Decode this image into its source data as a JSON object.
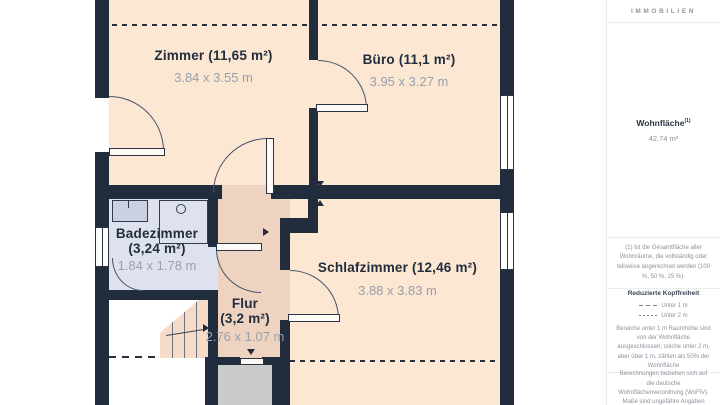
{
  "plan": {
    "rooms": {
      "zimmer": {
        "name": "Zimmer (11,65 m²)",
        "dims": "3.84 x 3.55 m"
      },
      "buero": {
        "name": "Büro (11,1 m²)",
        "dims": "3.95 x 3.27 m"
      },
      "badezimmer": {
        "name": "Badezimmer",
        "area": "(3,24 m²)",
        "dims": "1.84 x 1.78 m"
      },
      "schlafzimmer": {
        "name": "Schlafzimmer (12,46 m²)",
        "dims": "3.88 x 3.83 m"
      },
      "flur": {
        "name": "Flur",
        "area": "(3,2 m²)",
        "dims": "2.76 x 1.07 m"
      }
    },
    "colors": {
      "wall": "#212c3c",
      "floor_room": "#fbe7d2",
      "floor_hall": "#eed3c1",
      "floor_bath": "#dde2ee",
      "stairwell": "#cbcbcb"
    }
  },
  "sidebar": {
    "brand": "IMMOBILIEN",
    "area_label": "Wohnfläche",
    "area_sup": "(1)",
    "area_value": "42.74 m²",
    "footnote": "(1) Ist die Gesamtfläche aller Wohnräume, die vollständig oder teilweise angerechnet werden (100 %, 50 %, 25 %).",
    "legend": {
      "title": "Reduzierte Kopffreiheit",
      "items": [
        {
          "label": "Unter 1 m"
        },
        {
          "label": "Unter 2 m"
        }
      ],
      "note": "Bereiche unter 1 m Raumhöhe sind von der Wohnfläche ausgeschlossen; solche unter 2 m, aber über 1 m, zählen als 50% der Wohnfläche"
    },
    "disclaimer": "Berechnungen beziehen sich auf die deutsche Wohnflächenverordnung (WoFlV). Maße sind ungefähre Angaben"
  }
}
